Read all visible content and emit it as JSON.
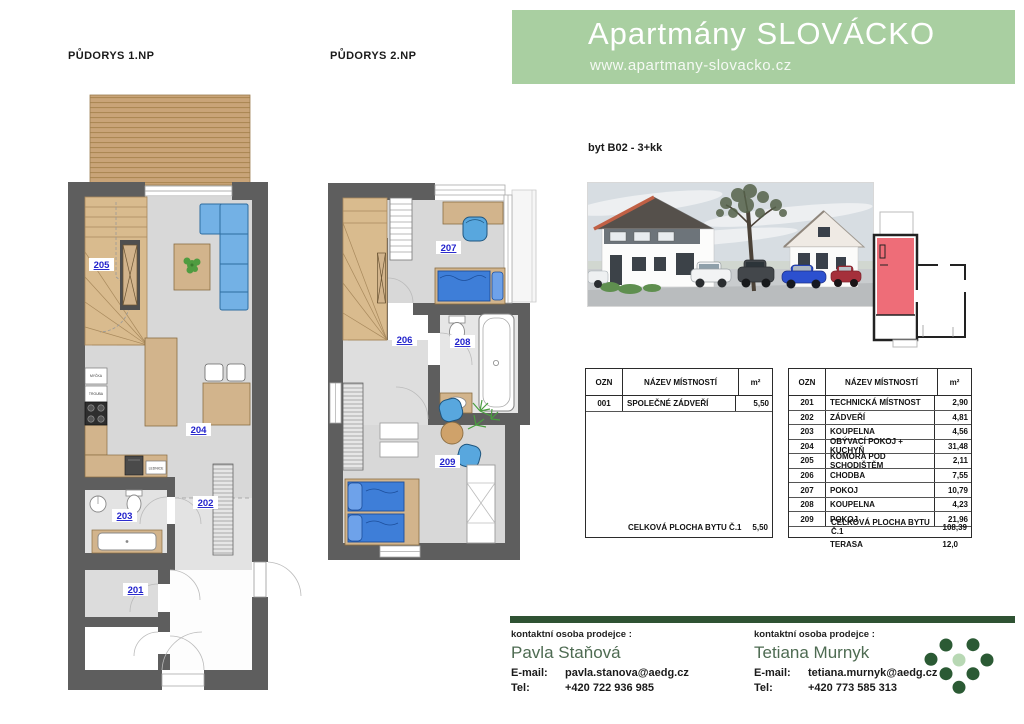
{
  "header": {
    "title": "Apartmány SLOVÁCKO",
    "url": "www.apartmany-slovacko.cz"
  },
  "unit": {
    "label": "byt B02 - 3+kk"
  },
  "plans": {
    "p1_title": "PŮDORYS 1.NP",
    "p2_title": "PŮDORYS 2.NP",
    "rooms": {
      "r201": "201",
      "r202": "202",
      "r203": "203",
      "r204": "204",
      "r205": "205",
      "r206": "206",
      "r207": "207",
      "r208": "208",
      "r209": "209"
    },
    "appliances": {
      "mycka": "MYČKA",
      "trouba": "TROUBA",
      "lednice": "LEDNICE"
    }
  },
  "tables": [
    {
      "headers": [
        "OZN",
        "NÁZEV MÍSTNOSTÍ",
        "m²"
      ],
      "rows": [
        [
          "001",
          "SPOLEČNÉ ZÁDVEŘÍ",
          "5,50"
        ]
      ],
      "footer": {
        "label": "CELKOVÁ PLOCHA BYTU Č.1",
        "value": "5,50"
      }
    },
    {
      "headers": [
        "OZN",
        "NÁZEV MÍSTNOSTÍ",
        "m²"
      ],
      "rows": [
        [
          "201",
          "TECHNICKÁ MÍSTNOST",
          "2,90"
        ],
        [
          "202",
          "ZÁDVEŘÍ",
          "4,81"
        ],
        [
          "203",
          "KOUPELNA",
          "4,56"
        ],
        [
          "204",
          "OBÝVACÍ POKOJ + KUCHYŇ",
          "31,48"
        ],
        [
          "205",
          "KOMORA POD SCHODIŠTĚM",
          "2,11"
        ],
        [
          "206",
          "CHODBA",
          "7,55"
        ],
        [
          "207",
          "POKOJ",
          "10,79"
        ],
        [
          "208",
          "KOUPELNA",
          "4,23"
        ],
        [
          "209",
          "POKOJ",
          "21,96"
        ]
      ],
      "footer": {
        "label": "CELKOVÁ PLOCHA BYTU Č.1",
        "value": "108,39"
      },
      "extra": {
        "label": "TERASA",
        "value": "12,0"
      }
    }
  ],
  "contacts": [
    {
      "heading": "kontaktní osoba prodejce :",
      "name": "Pavla Staňová",
      "email_label": "E-mail:",
      "email": "pavla.stanova@aedg.cz",
      "tel_label": "Tel:",
      "tel": "+420 722 936 985"
    },
    {
      "heading": "kontaktní osoba prodejce :",
      "name": "Tetiana Murnyk",
      "email_label": "E-mail:",
      "email": "tetiana.murnyk@aedg.cz",
      "tel_label": "Tel:",
      "tel": "+420 773 585 313"
    }
  ],
  "colors": {
    "header_green": "#a9cfa1",
    "divider_green": "#2f5233",
    "logo_dark": "#2b5a34",
    "logo_light": "#b8d8b4",
    "highlight_red": "#ee6d78",
    "room_label_blue": "#2121cc"
  }
}
